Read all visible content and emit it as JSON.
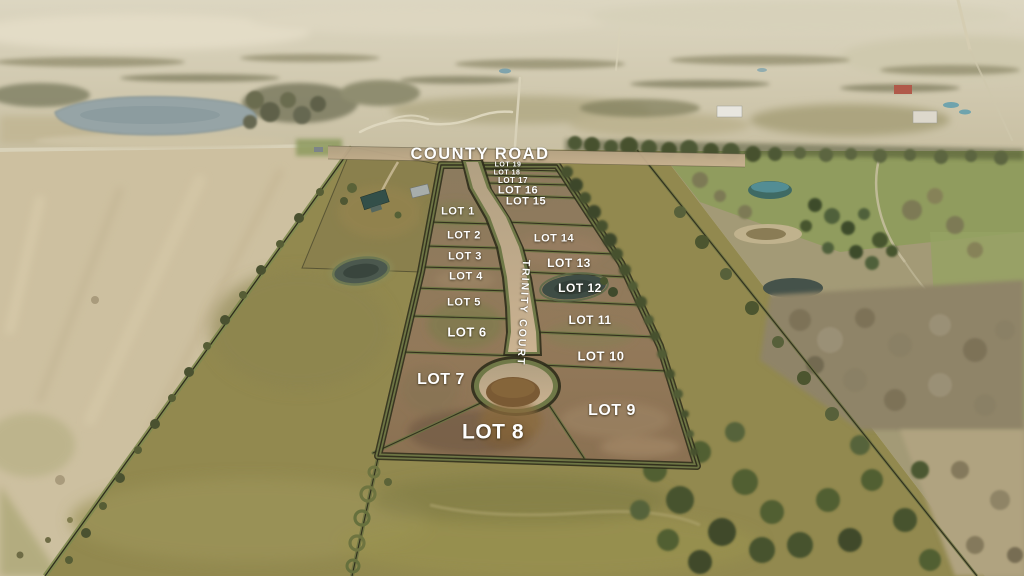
{
  "roads": {
    "county_road": "COUNTY ROAD",
    "trinity_court": "TRINITY COURT"
  },
  "lots": [
    {
      "label": "LOT 1"
    },
    {
      "label": "LOT 2"
    },
    {
      "label": "LOT 3"
    },
    {
      "label": "LOT 4"
    },
    {
      "label": "LOT 5"
    },
    {
      "label": "LOT 6"
    },
    {
      "label": "LOT 7"
    },
    {
      "label": "LOT 8"
    },
    {
      "label": "LOT 9"
    },
    {
      "label": "LOT 10"
    },
    {
      "label": "LOT 11"
    },
    {
      "label": "LOT 12"
    },
    {
      "label": "LOT 13"
    },
    {
      "label": "LOT 14"
    },
    {
      "label": "LOT 15"
    },
    {
      "label": "LOT 16"
    },
    {
      "label": "LOT 17"
    },
    {
      "label": "LOT 18"
    },
    {
      "label": "LOT 19"
    }
  ],
  "colors": {
    "label_text": "#ffffff",
    "plat_overlay": "#8f7a5c",
    "boundary_green": "#6d7544",
    "pasture": "#92894f",
    "pale_field": "#cdc0a0",
    "lake": "#96a4a6",
    "road_pavement": "#c2ab89"
  }
}
